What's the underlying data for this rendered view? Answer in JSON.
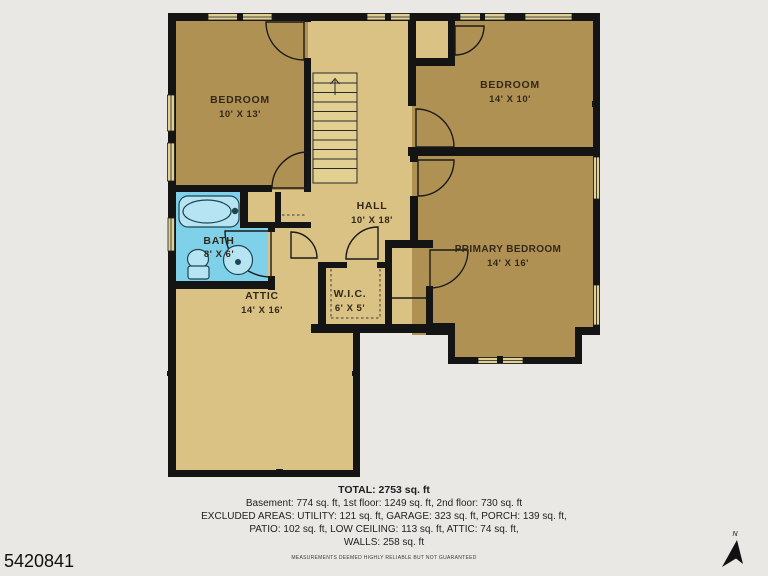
{
  "meta": {
    "listing_id": "5420841",
    "compass_label": "N"
  },
  "rooms": {
    "bedroom1": {
      "name": "BEDROOM",
      "dims": "10' X 13'"
    },
    "bedroom2": {
      "name": "BEDROOM",
      "dims": "14' X 10'"
    },
    "hall": {
      "name": "HALL",
      "dims": "10' X 18'"
    },
    "bath": {
      "name": "BATH",
      "dims": "8' X 6'"
    },
    "attic": {
      "name": "ATTIC",
      "dims": "14' X 16'"
    },
    "wic": {
      "name": "W.I.C.",
      "dims": "6' X 5'"
    },
    "primary": {
      "name": "PRIMARY BEDROOM",
      "dims": "14' X 16'"
    }
  },
  "summary": {
    "total": "TOTAL: 2753 sq. ft",
    "floors": "Basement: 774 sq. ft, 1st floor: 1249 sq. ft, 2nd floor: 730 sq. ft",
    "excluded1": "EXCLUDED AREAS: UTILITY: 121 sq. ft, GARAGE: 323 sq. ft, PORCH: 139 sq. ft,",
    "excluded2": "PATIO: 102 sq. ft, LOW CEILING: 113 sq. ft, ATTIC: 74 sq. ft,",
    "walls": "WALLS: 258 sq. ft",
    "disclaimer": "MEASUREMENTS DEEMED HIGHLY RELIABLE BUT NOT GUARANTEED"
  },
  "colors": {
    "background": "#e9e8e5",
    "wall": "#141414",
    "room_dark_tan": "#b09154",
    "room_light_tan": "#dac285",
    "stairs_fill": "#e2cf92",
    "window_fill": "#e0d096",
    "bath_blue": "#7ed1e9",
    "fixture_fill": "#b7e4f2",
    "fixture_stroke": "#1d4552",
    "label_color": "#33291a"
  }
}
